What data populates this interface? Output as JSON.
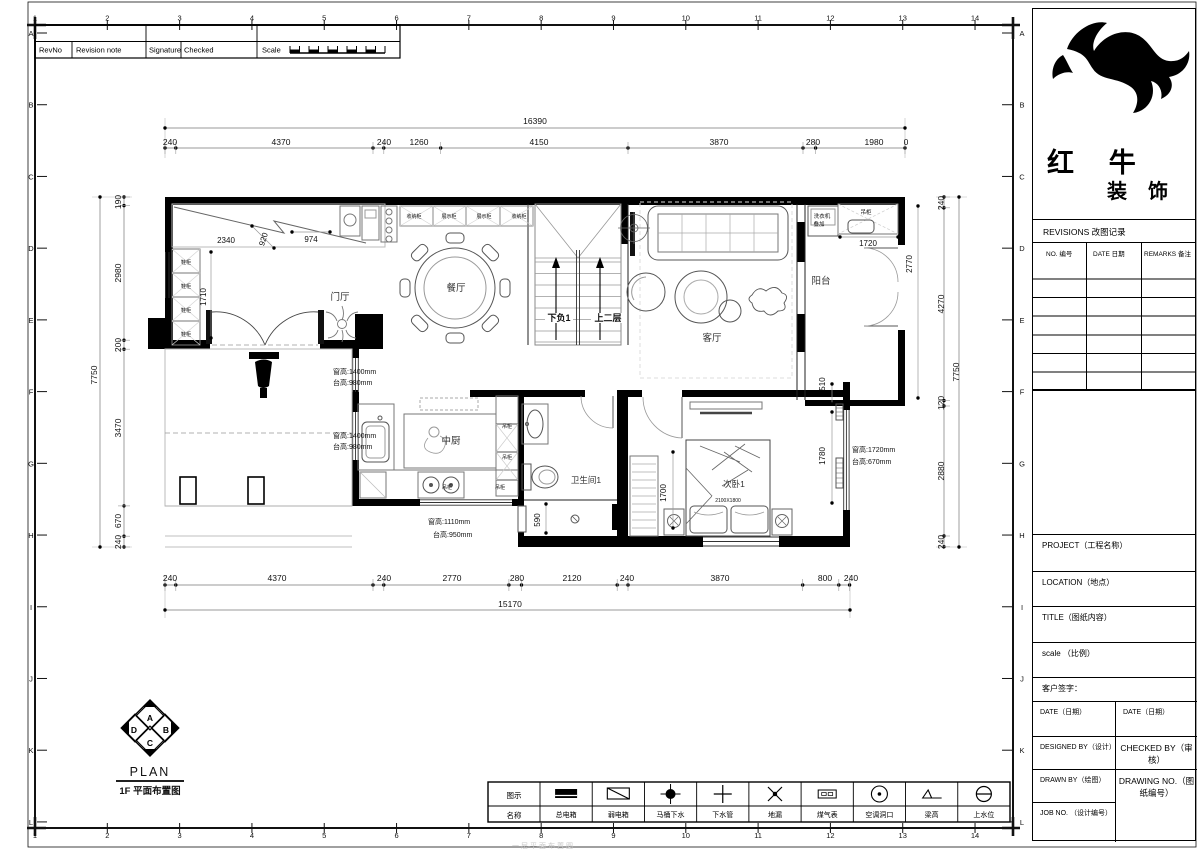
{
  "sheet": {
    "rev_strip": {
      "rev_no": "RevNo",
      "revision_note": "Revision note",
      "signature": "Signature",
      "checked": "Checked",
      "scale": "Scale"
    },
    "frame": {
      "columns": [
        "1",
        "2",
        "3",
        "4",
        "5",
        "6",
        "7",
        "8",
        "9",
        "10",
        "11",
        "12",
        "13",
        "14"
      ],
      "rows": [
        "A",
        "B",
        "C",
        "D",
        "E",
        "F",
        "G",
        "H",
        "I",
        "J",
        "K",
        "L"
      ]
    }
  },
  "title_block": {
    "brand_line1": "红 牛",
    "brand_line2": "装 饰",
    "revisions_title": "REVISIONS 改图记录",
    "rev_col_no": "NO. 编号",
    "rev_col_date": "DATE 日期",
    "rev_col_remarks": "REMARKS 备注",
    "project_label": "PROJECT（工程名称）",
    "location_label": "LOCATION（地点）",
    "title_label": "TITLE（图纸内容）",
    "scale_label": "scale （比例）",
    "customer_sign_label": "客户签字：",
    "date_left_label": "DATE（日期）",
    "date_right_label": "DATE（日期）",
    "designed_by_label": "DESIGNED BY（设计）",
    "checked_by_label": "CHECKED BY（审核）",
    "drawn_by_label": "DRAWN BY（绘图）",
    "drawing_no_label": "DRAWING NO.（图纸编号）",
    "job_no_label": "JOB NO. （设计编号）"
  },
  "legend": {
    "header_icon": "图示",
    "header_name": "名称",
    "items": [
      {
        "name": "总电箱",
        "icon": "main-electric-box"
      },
      {
        "name": "弱电箱",
        "icon": "weak-electric-box"
      },
      {
        "name": "马桶下水",
        "icon": "toilet-drain"
      },
      {
        "name": "下水管",
        "icon": "drain-pipe"
      },
      {
        "name": "地漏",
        "icon": "floor-drain"
      },
      {
        "name": "煤气表",
        "icon": "gas-meter"
      },
      {
        "name": "空调洞口",
        "icon": "ac-hole"
      },
      {
        "name": "梁高",
        "icon": "beam-height"
      },
      {
        "name": "上水位",
        "icon": "water-supply"
      }
    ]
  },
  "plan_footer": {
    "compass_letters": {
      "top": "A",
      "right": "B",
      "bottom": "C",
      "left": "D"
    },
    "plan_label": "PLAN",
    "floor_label": "1F  平面布置图"
  },
  "footer_watermark": "一层平面布置图",
  "plan": {
    "texts": [
      {
        "t": "16390",
        "x": 535,
        "y": 124
      },
      {
        "t": "240",
        "x": 170,
        "y": 145
      },
      {
        "t": "4370",
        "x": 281,
        "y": 145
      },
      {
        "t": "240",
        "x": 384,
        "y": 145
      },
      {
        "t": "1260",
        "x": 419,
        "y": 145
      },
      {
        "t": "4150",
        "x": 539,
        "y": 145
      },
      {
        "t": "3870",
        "x": 719,
        "y": 145
      },
      {
        "t": "280",
        "x": 813,
        "y": 145
      },
      {
        "t": "1980",
        "x": 874,
        "y": 145
      },
      {
        "t": "0",
        "x": 906,
        "y": 145
      },
      {
        "t": "240",
        "x": 170,
        "y": 581
      },
      {
        "t": "4370",
        "x": 277,
        "y": 581
      },
      {
        "t": "240",
        "x": 384,
        "y": 581
      },
      {
        "t": "2770",
        "x": 452,
        "y": 581
      },
      {
        "t": "280",
        "x": 517,
        "y": 581
      },
      {
        "t": "2120",
        "x": 572,
        "y": 581
      },
      {
        "t": "240",
        "x": 627,
        "y": 581
      },
      {
        "t": "3870",
        "x": 720,
        "y": 581
      },
      {
        "t": "800",
        "x": 825,
        "y": 581
      },
      {
        "t": "240",
        "x": 851,
        "y": 581
      },
      {
        "t": "15170",
        "x": 510,
        "y": 607
      },
      {
        "t": "7750",
        "x": 97,
        "y": 375,
        "r": -90
      },
      {
        "t": "190",
        "x": 121,
        "y": 202,
        "r": -90
      },
      {
        "t": "2980",
        "x": 121,
        "y": 273,
        "r": -90
      },
      {
        "t": "200",
        "x": 121,
        "y": 345,
        "r": -90
      },
      {
        "t": "3470",
        "x": 121,
        "y": 428,
        "r": -90
      },
      {
        "t": "670",
        "x": 121,
        "y": 521,
        "r": -90
      },
      {
        "t": "240",
        "x": 121,
        "y": 542,
        "r": -90
      },
      {
        "t": "7750",
        "x": 959,
        "y": 372,
        "r": -90
      },
      {
        "t": "240",
        "x": 944,
        "y": 203,
        "r": -90
      },
      {
        "t": "4270",
        "x": 944,
        "y": 304,
        "r": -90
      },
      {
        "t": "120",
        "x": 944,
        "y": 403,
        "r": -90
      },
      {
        "t": "2880",
        "x": 944,
        "y": 471,
        "r": -90
      },
      {
        "t": "240",
        "x": 944,
        "y": 542,
        "r": -90
      },
      {
        "t": "2340",
        "x": 226,
        "y": 243,
        "s": 8
      },
      {
        "t": "920",
        "x": 266,
        "y": 240,
        "s": 8,
        "r": -72
      },
      {
        "t": "974",
        "x": 311,
        "y": 242,
        "s": 8
      },
      {
        "t": "1710",
        "x": 206,
        "y": 297,
        "s": 8,
        "r": -90
      },
      {
        "t": "1720",
        "x": 868,
        "y": 246,
        "s": 8
      },
      {
        "t": "2770",
        "x": 912,
        "y": 264,
        "s": 8,
        "r": -90
      },
      {
        "t": "510",
        "x": 825,
        "y": 384,
        "s": 8,
        "r": -90
      },
      {
        "t": "1780",
        "x": 825,
        "y": 456,
        "s": 8,
        "r": -90
      },
      {
        "t": "1700",
        "x": 666,
        "y": 493,
        "s": 8,
        "r": -90
      },
      {
        "t": "590",
        "x": 540,
        "y": 520,
        "s": 8,
        "r": -90
      },
      {
        "t": "2100X1800",
        "x": 728,
        "y": 502,
        "s": 5
      },
      {
        "t": "门厅",
        "x": 340,
        "y": 300,
        "s": 9.5,
        "c": "#333"
      },
      {
        "t": "餐厅",
        "x": 456,
        "y": 291,
        "s": 9.5,
        "c": "#333"
      },
      {
        "t": "客厅",
        "x": 712,
        "y": 341,
        "s": 9.5,
        "c": "#333"
      },
      {
        "t": "阳台",
        "x": 821,
        "y": 284,
        "s": 9.5,
        "c": "#333"
      },
      {
        "t": "中厨",
        "x": 451,
        "y": 444,
        "s": 9.5,
        "c": "#333"
      },
      {
        "t": "卫生间1",
        "x": 586,
        "y": 483,
        "s": 8.5,
        "c": "#333"
      },
      {
        "t": "次卧1",
        "x": 734,
        "y": 487,
        "s": 8.5,
        "c": "#333"
      },
      {
        "t": "下负1",
        "x": 559,
        "y": 321,
        "s": 9,
        "b": 1
      },
      {
        "t": "上二层",
        "x": 608,
        "y": 321,
        "s": 9,
        "b": 1
      },
      {
        "t": "窗高:1400mm",
        "x": 333,
        "y": 374,
        "s": 7,
        "a": "s"
      },
      {
        "t": "台高:980mm",
        "x": 333,
        "y": 385,
        "s": 7,
        "a": "s"
      },
      {
        "t": "窗高:1400mm",
        "x": 333,
        "y": 438,
        "s": 7,
        "a": "s"
      },
      {
        "t": "台高:980mm",
        "x": 333,
        "y": 449,
        "s": 7,
        "a": "s"
      },
      {
        "t": "窗高:1110mm",
        "x": 428,
        "y": 524,
        "s": 7,
        "a": "s"
      },
      {
        "t": "台高:950mm",
        "x": 433,
        "y": 537,
        "s": 7,
        "a": "s"
      },
      {
        "t": "窗高:1720mm",
        "x": 852,
        "y": 452,
        "s": 7,
        "a": "s"
      },
      {
        "t": "台高:670mm",
        "x": 852,
        "y": 464,
        "s": 7,
        "a": "s"
      },
      {
        "t": "洗衣机",
        "x": 822,
        "y": 218,
        "s": 5.5
      },
      {
        "t": "叠加",
        "x": 819,
        "y": 226,
        "s": 5.5
      },
      {
        "t": "吊柜",
        "x": 866,
        "y": 214,
        "s": 5.5
      },
      {
        "t": "收纳柜",
        "x": 414,
        "y": 218,
        "s": 5
      },
      {
        "t": "展示柜",
        "x": 449,
        "y": 218,
        "s": 5
      },
      {
        "t": "展示柜",
        "x": 484,
        "y": 218,
        "s": 5
      },
      {
        "t": "收纳柜",
        "x": 519,
        "y": 218,
        "s": 5
      },
      {
        "t": "吊柜",
        "x": 507,
        "y": 428,
        "s": 5
      },
      {
        "t": "吊柜",
        "x": 507,
        "y": 459,
        "s": 5
      },
      {
        "t": "吊柜",
        "x": 447,
        "y": 489,
        "s": 5
      },
      {
        "t": "吊柜",
        "x": 500,
        "y": 489,
        "s": 5
      },
      {
        "t": "鞋柜",
        "x": 186,
        "y": 264,
        "s": 5
      },
      {
        "t": "鞋柜",
        "x": 186,
        "y": 288,
        "s": 5
      },
      {
        "t": "鞋柜",
        "x": 186,
        "y": 312,
        "s": 5
      },
      {
        "t": "鞋柜",
        "x": 186,
        "y": 336,
        "s": 5
      }
    ]
  }
}
